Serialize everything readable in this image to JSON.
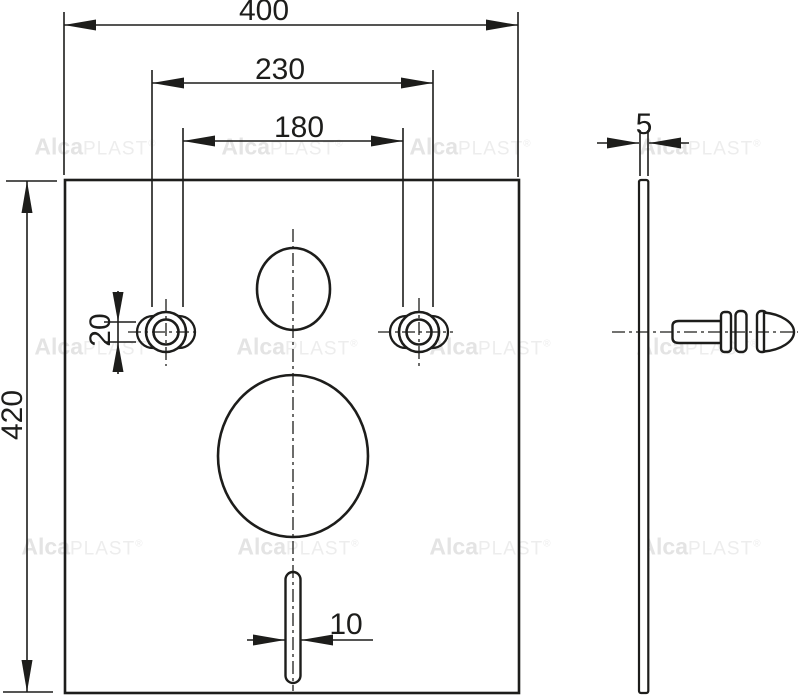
{
  "colors": {
    "line": "#1d1d1b",
    "watermark_bold": "#e4e4e4",
    "watermark_light": "#ededed"
  },
  "front_view": {
    "dim_width": "400",
    "dim_bolt_spacing_outer": "230",
    "dim_bolt_spacing_inner": "180",
    "dim_height": "420",
    "dim_bolt_hole": "20",
    "dim_slot": "10"
  },
  "side_view": {
    "dim_thickness": "5"
  },
  "watermark": {
    "bold": "Alca",
    "light": "PLAST",
    "reg": "®"
  }
}
